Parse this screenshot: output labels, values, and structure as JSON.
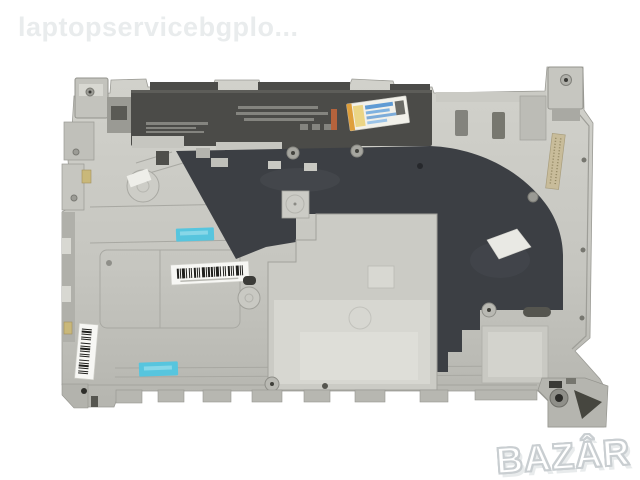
{
  "watermark": {
    "text": "laptopservicebgplo..."
  },
  "brand_logo": {
    "text": "BAZÂR"
  },
  "photo": {
    "subject": "laptop bottom base cover with inner metal frame, blue tapes, barcode stickers and license label"
  },
  "colors": {
    "background": "#ffffff",
    "watermark": "#e9eced",
    "logo_fill": "#ffffff",
    "logo_outline": "#c9ced1",
    "chassis": "#c6c6c0",
    "chassis_light": "#d8d8d2",
    "chassis_dark": "#b0b0aa",
    "edge_line": "#9a9a94",
    "panel_black": "#3c3f44",
    "battery_strip": "#4b4b48",
    "tape_cyan": "#57c5de",
    "sticker_base": "#f2f1ea",
    "sticker_orange": "#df9f3b",
    "sticker_blue": "#5f9bd4",
    "gold_strip": "#c8bc9a",
    "label_white": "#f7f7f4",
    "barcode_ink": "#20201d",
    "orange_chip": "#b5633c"
  }
}
